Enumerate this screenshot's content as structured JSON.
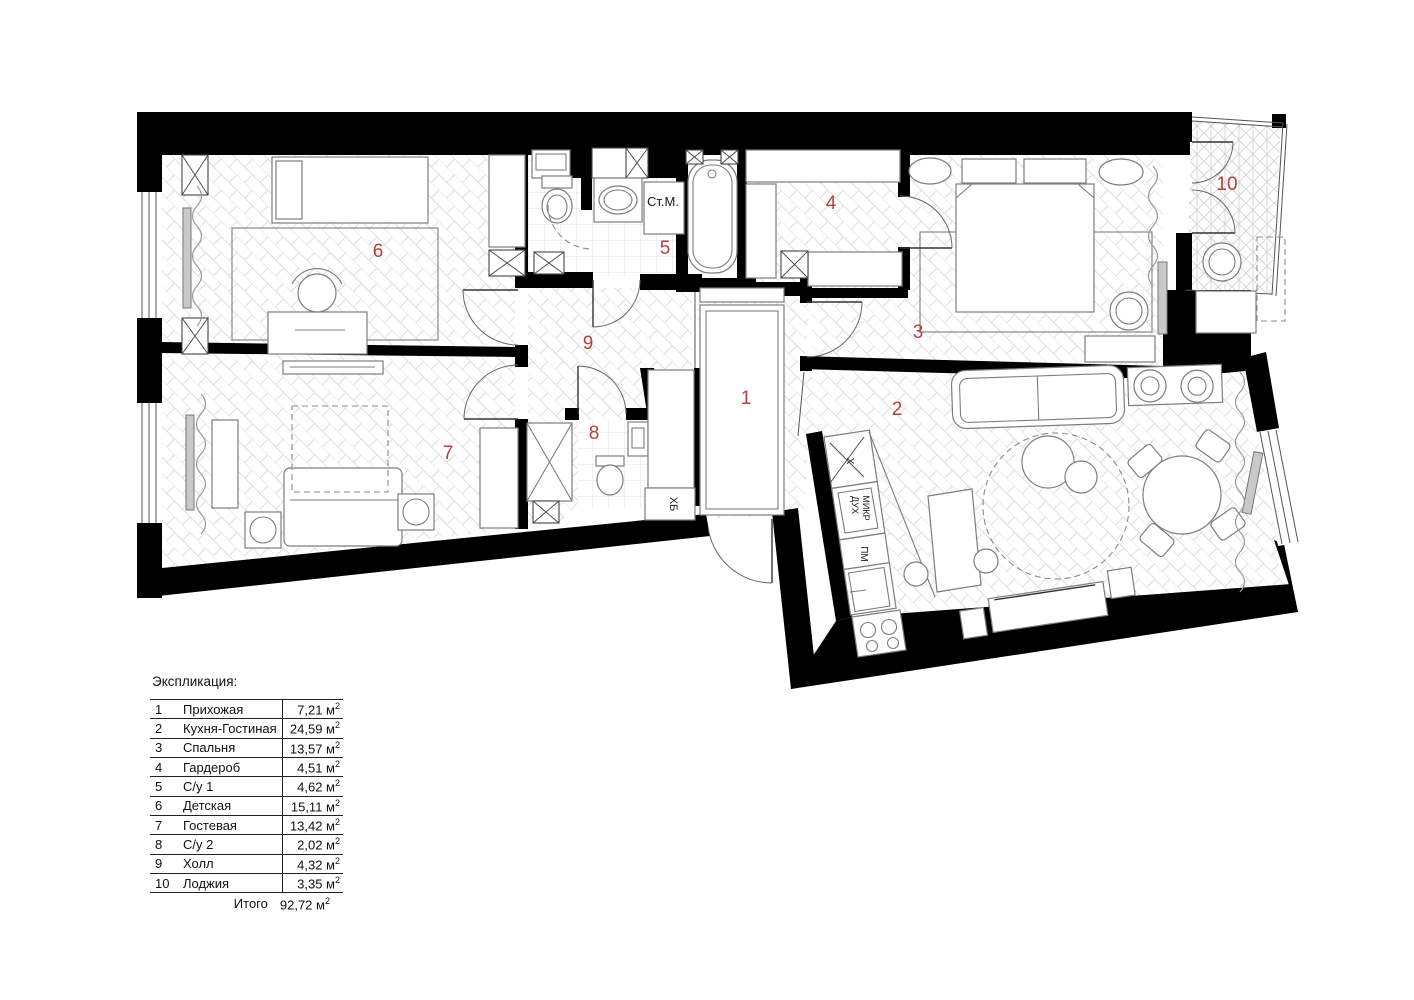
{
  "colors": {
    "room_number": "#b5403c",
    "wall": "#000000"
  },
  "legend": {
    "title": "Экспликация:",
    "unit_base": "м",
    "unit_sup": "2",
    "rows": [
      {
        "num": "1",
        "name": "Прихожая",
        "area": "7,21"
      },
      {
        "num": "2",
        "name": "Кухня-Гостиная",
        "area": "24,59"
      },
      {
        "num": "3",
        "name": "Спальня",
        "area": "13,57"
      },
      {
        "num": "4",
        "name": "Гардероб",
        "area": "4,51"
      },
      {
        "num": "5",
        "name": "С/у 1",
        "area": "4,62"
      },
      {
        "num": "6",
        "name": "Детская",
        "area": "15,11"
      },
      {
        "num": "7",
        "name": "Гостевая",
        "area": "13,42"
      },
      {
        "num": "8",
        "name": "С/у 2",
        "area": "2,02"
      },
      {
        "num": "9",
        "name": "Холл",
        "area": "4,32"
      },
      {
        "num": "10",
        "name": "Лоджия",
        "area": "3,35"
      }
    ],
    "total_label": "Итого",
    "total_area": "92,72"
  },
  "plan": {
    "rooms": [
      {
        "num": "1",
        "x": 746,
        "y": 404
      },
      {
        "num": "2",
        "x": 897,
        "y": 415
      },
      {
        "num": "3",
        "x": 918,
        "y": 338
      },
      {
        "num": "4",
        "x": 831,
        "y": 209
      },
      {
        "num": "5",
        "x": 665,
        "y": 254
      },
      {
        "num": "6",
        "x": 378,
        "y": 257
      },
      {
        "num": "7",
        "x": 448,
        "y": 459
      },
      {
        "num": "8",
        "x": 594,
        "y": 439
      },
      {
        "num": "9",
        "x": 588,
        "y": 349
      },
      {
        "num": "10",
        "x": 1227,
        "y": 190
      }
    ],
    "annotations": [
      {
        "text": "Ст.М.",
        "x": 663,
        "y": 206,
        "rot": 0,
        "size": 13
      },
      {
        "text": "ХБ",
        "x": 670,
        "y": 504,
        "rot": 90,
        "size": 11
      },
      {
        "text": "Х",
        "x": 847,
        "y": 461,
        "rot": 90,
        "size": 10
      },
      {
        "text": "ДУХ",
        "x": 852,
        "y": 505,
        "rot": 90,
        "size": 9
      },
      {
        "text": "МИКР",
        "x": 863,
        "y": 508,
        "rot": 90,
        "size": 9
      },
      {
        "text": "ПМ",
        "x": 861,
        "y": 554,
        "rot": 90,
        "size": 10
      }
    ]
  }
}
